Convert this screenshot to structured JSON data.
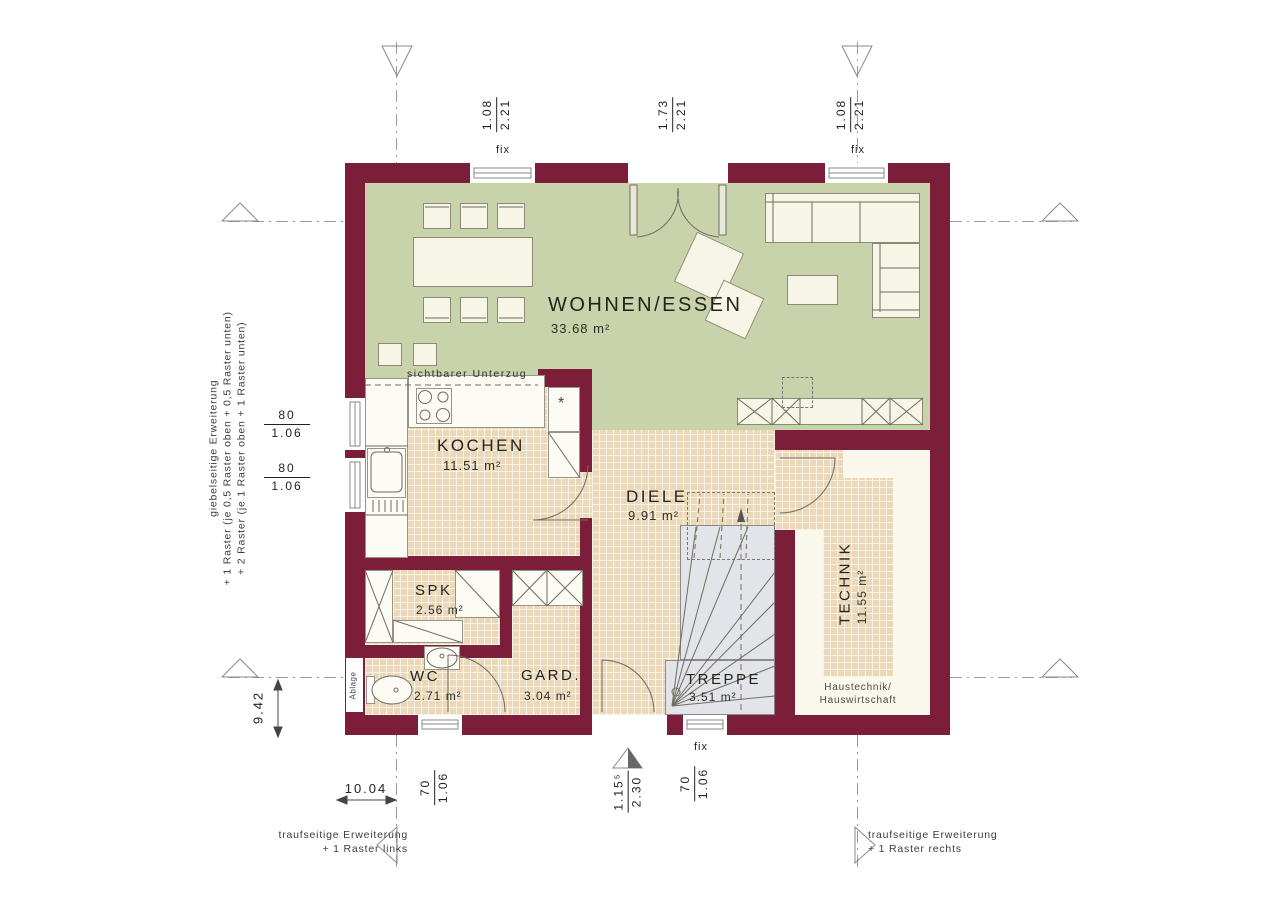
{
  "rooms": {
    "wohnen": {
      "name": "WOHNEN/ESSEN",
      "area": "33.68 m²"
    },
    "kochen": {
      "name": "KOCHEN",
      "area": "11.51 m²"
    },
    "diele": {
      "name": "DIELE",
      "area": "9.91 m²"
    },
    "spk": {
      "name": "SPK",
      "area": "2.56 m²"
    },
    "wc": {
      "name": "WC",
      "area": "2.71 m²"
    },
    "gard": {
      "name": "GARD.",
      "area": "3.04 m²"
    },
    "treppe": {
      "name": "TREPPE",
      "area": "3.51 m²"
    },
    "technik": {
      "name": "TECHNIK",
      "area": "11.55 m²"
    }
  },
  "labels": {
    "beam": "sichtbarer Unterzug",
    "ablage": "Ablage",
    "haustechnik1": "Haustechnik/",
    "haustechnik2": "Hauswirtschaft",
    "fix": "fix",
    "star": "*"
  },
  "dimensions": {
    "top_left": {
      "num": "1.08",
      "den": "2.21"
    },
    "top_mid": {
      "num": "1.73",
      "den": "2.21"
    },
    "top_right": {
      "num": "1.08",
      "den": "2.21"
    },
    "left_upper": {
      "num": "80",
      "den": "1.06"
    },
    "left_lower": {
      "num": "80",
      "den": "1.06"
    },
    "bottom_left": {
      "num": "70",
      "den": "1.06"
    },
    "bottom_door": {
      "num": "1.15⁵",
      "den": "2.30"
    },
    "bottom_right": {
      "num": "70",
      "den": "1.06"
    },
    "total_width": "10.04",
    "total_height": "9.42"
  },
  "notes": {
    "left": {
      "line1": "giebelseitige Erweiterung",
      "line2": "+ 1 Raster (je 0,5 Raster oben + 0,5 Raster unten)",
      "line3": "+ 2 Raster (je 1 Raster oben + 1 Raster unten)"
    },
    "bottom_left": {
      "line1": "traufseitige Erweiterung",
      "line2": "+ 1 Raster links"
    },
    "bottom_right": {
      "line1": "traufseitige Erweiterung",
      "line2": "+ 1 Raster rechts"
    }
  },
  "colors": {
    "wall": "#7c1e3a",
    "living_floor": "#c8d2ab",
    "tile_floor": "#ebd8b8",
    "stair": "#e2e4e9",
    "furniture": "#f7f5e5",
    "technik_floor": "#faf7ed"
  }
}
